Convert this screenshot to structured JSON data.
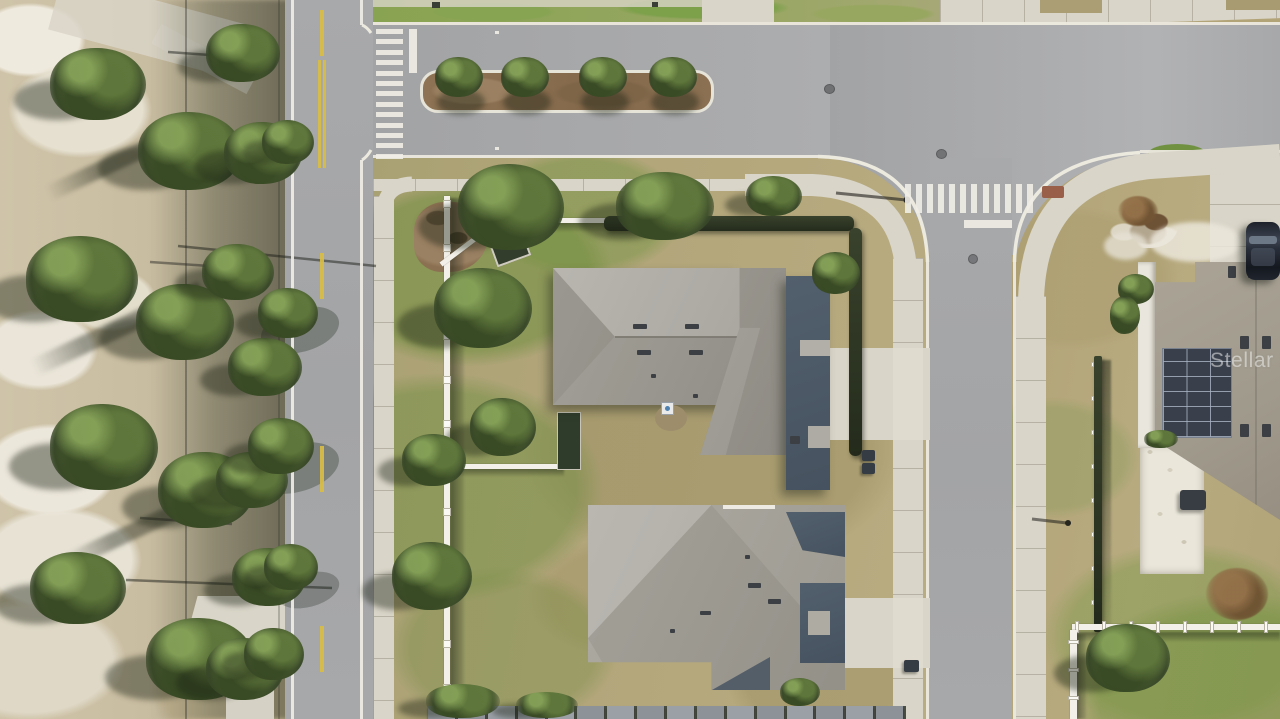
{
  "scene": {
    "type": "aerial-drone-photograph",
    "setting": "residential corner lot with two gray hip-roof houses, bordering streets, landscaped median, crosswalks, and neighboring home with rooftop solar panels next to undeveloped scrub land",
    "watermark": {
      "text": "Stellar MLS"
    },
    "objects": {
      "houses": 3,
      "streets": 3,
      "crosswalks": 2,
      "parked_cars": 1
    }
  },
  "palette": {
    "asphalt": "#a6a7a9",
    "concrete": "#d9d5c8",
    "concrete_bright": "#e2ded2",
    "curb": "#ece9df",
    "lawn_dry": "#b3a478",
    "lawn_green": "#7d9a4c",
    "scrub_sand": "#eae5d8",
    "scrub_base": "#c9bda2",
    "tree_mid": "#4c5f33",
    "tree_dark": "#324122",
    "mulch": "#8b7052",
    "roof_light": "#a6a39b",
    "roof_dark": "#4d5a67",
    "hedge": "#2e3725",
    "fence_white": "#f2f0e8",
    "paint_white": "#efede5",
    "paint_yellow": "#d9bd45",
    "solar_panel": "#39404c",
    "car_body": "#232831",
    "watermark_color": "rgba(255,255,255,0.48)"
  },
  "features": {
    "crosswalk_left": {
      "stripes": 13
    },
    "crosswalk_top": {
      "stripes": 12
    },
    "median": {
      "trees": 4
    },
    "center_dashes": {
      "count": 4
    },
    "west_fence": {
      "posts": 12
    },
    "white_fence_h": {
      "posts": 8
    },
    "white_fence_v": {
      "posts": 3
    },
    "dark_fence": {
      "posts": 8
    },
    "bottom_fence": {
      "panels": 16
    }
  }
}
